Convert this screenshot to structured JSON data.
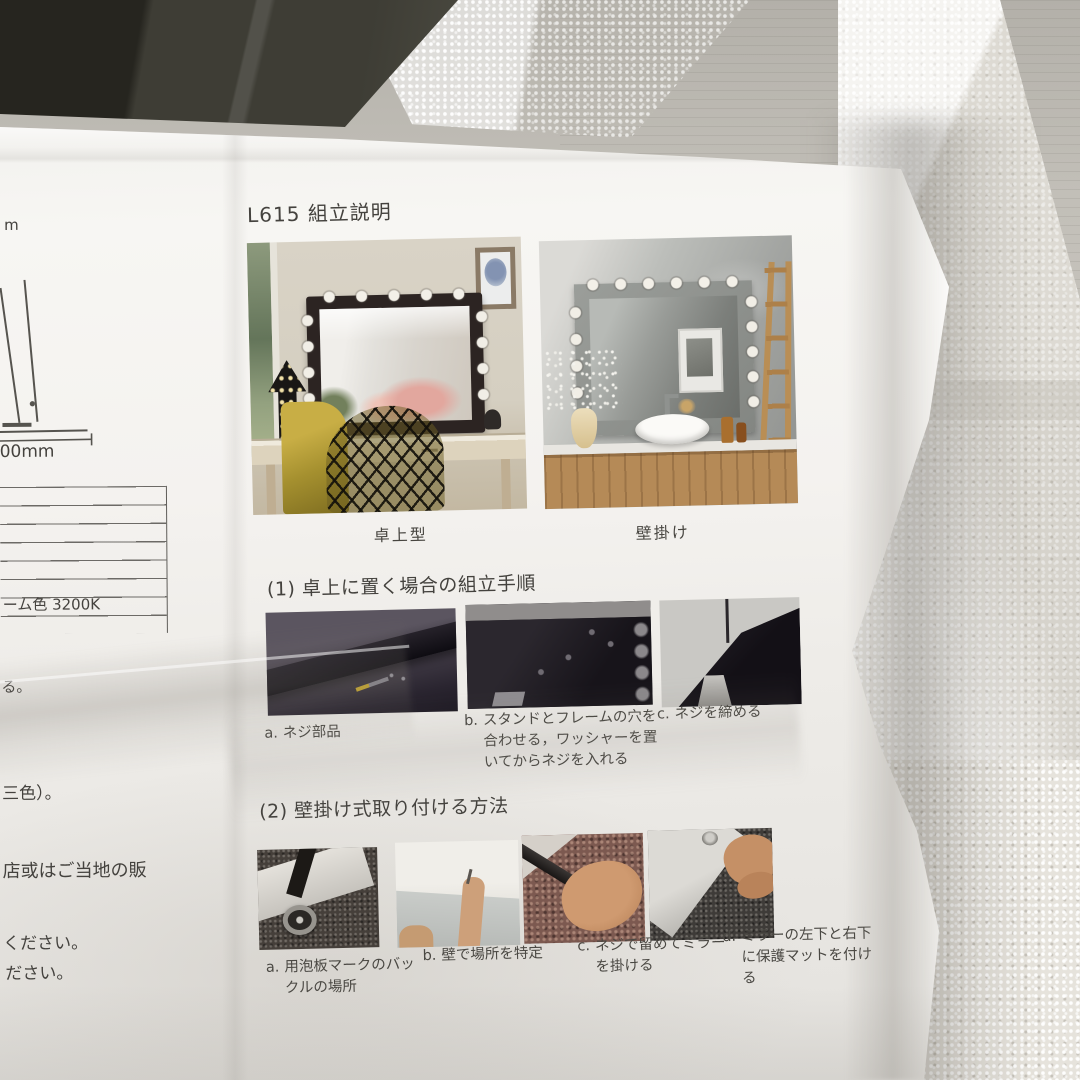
{
  "manual": {
    "title": "L615 組立説明",
    "mirror_types": [
      {
        "caption": "卓上型"
      },
      {
        "caption": "壁掛け"
      }
    ],
    "sections": [
      {
        "heading": "(1) 卓上に置く場合の組立手順",
        "steps": [
          {
            "prefix": "a.",
            "text": "ネジ部品"
          },
          {
            "prefix": "b.",
            "text": "スタンドとフレームの穴を合わせる，ワッシャーを置いてからネジを入れる"
          },
          {
            "prefix": "c.",
            "text": "ネジを締める"
          }
        ]
      },
      {
        "heading": "(2) 壁掛け式取り付ける方法",
        "steps": [
          {
            "prefix": "a.",
            "text": "用泡板マークのバックルの場所"
          },
          {
            "prefix": "b.",
            "text": "壁で場所を特定"
          },
          {
            "prefix": "c.",
            "text": "ネジで留めてミラーを掛ける"
          },
          {
            "prefix": "d.",
            "text": "ミラーの左下と右下に保護マットを付ける"
          }
        ]
      }
    ]
  },
  "left_margin": {
    "fragment_top": "m",
    "dimension_label": "00mm",
    "table_row_label": "ーム色 3200K",
    "fragment_1": "る。",
    "fragment_2": "三色）。",
    "fragment_3": "店或はご当地の販",
    "fragment_4": "ください。",
    "fragment_5": "ださい。"
  },
  "colors": {
    "paper": "#f4f2ef",
    "ink": "#44423e",
    "surface": "#c2bfb8",
    "foam": "#e6e3dc",
    "dark_object": "#3e3d35"
  }
}
